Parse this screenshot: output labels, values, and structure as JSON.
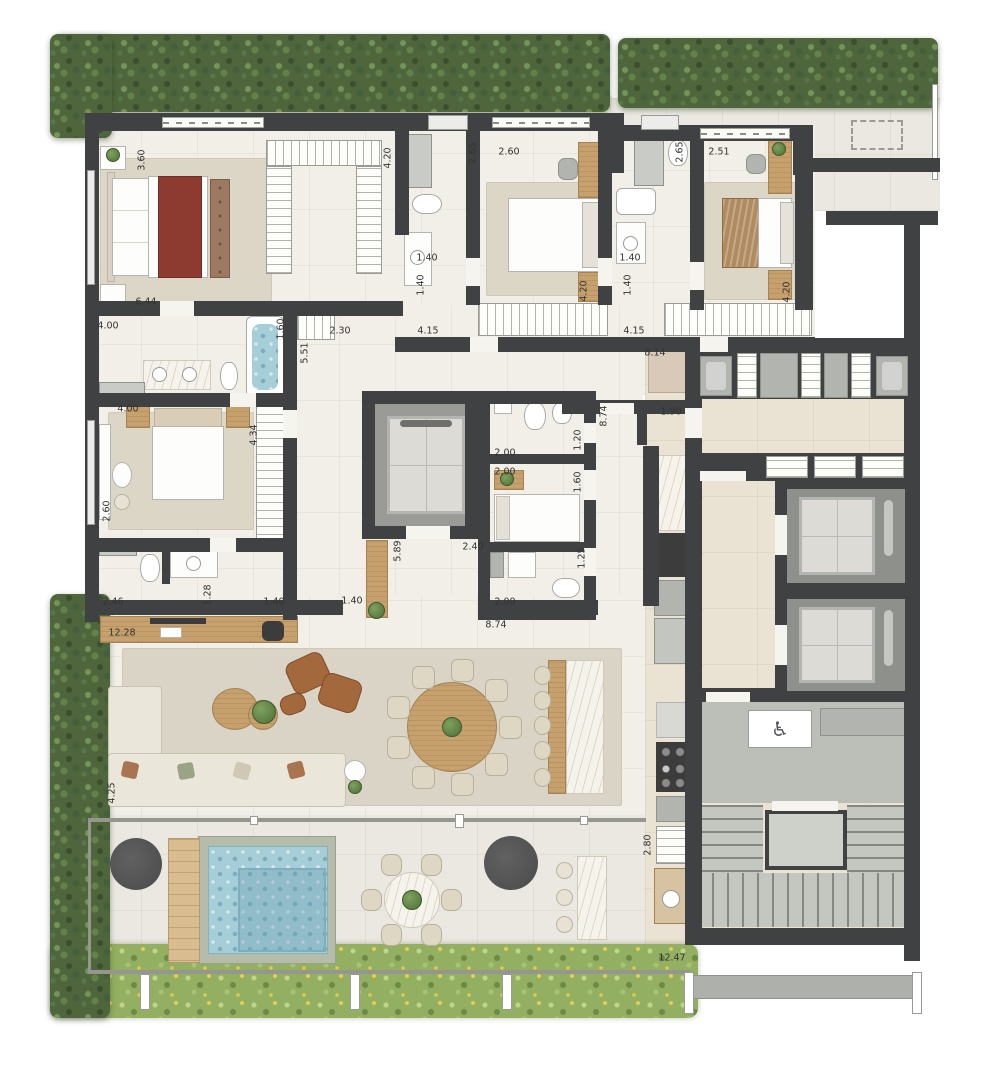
{
  "floorplan": {
    "type": "apartment-floor-plan",
    "icons": {
      "accessibility": "♿"
    },
    "palette": {
      "wall": "#3f4142",
      "floor": "#f2efe8",
      "terrace": "#ebe8e1",
      "hall_tile": "#eae2d2",
      "concrete": "#bcbfb7",
      "pool_water": "#a6ced8",
      "wood": "#c6a06d",
      "hedge_green": "#4f663d",
      "grass_green": "#93af62",
      "bed_accent_red": "#8d3a31",
      "leather_brown": "#a3683c"
    },
    "dimension_labels": [
      {
        "text": "3.60",
        "x": 142,
        "y": 160,
        "rot": 90
      },
      {
        "text": "6.44",
        "x": 146,
        "y": 302,
        "rot": 0
      },
      {
        "text": "4.20",
        "x": 388,
        "y": 158,
        "rot": 90
      },
      {
        "text": "2.65",
        "x": 473,
        "y": 153,
        "rot": 90
      },
      {
        "text": "2.60",
        "x": 509,
        "y": 152,
        "rot": 0
      },
      {
        "text": "1.40",
        "x": 427,
        "y": 258,
        "rot": 0
      },
      {
        "text": "1.40",
        "x": 421,
        "y": 285,
        "rot": 90
      },
      {
        "text": "4.15",
        "x": 428,
        "y": 331,
        "rot": 0
      },
      {
        "text": "2.65",
        "x": 680,
        "y": 152,
        "rot": 90
      },
      {
        "text": "1.40",
        "x": 630,
        "y": 258,
        "rot": 0
      },
      {
        "text": "1.40",
        "x": 628,
        "y": 285,
        "rot": 90
      },
      {
        "text": "4.15",
        "x": 634,
        "y": 331,
        "rot": 0
      },
      {
        "text": "2.51",
        "x": 719,
        "y": 152,
        "rot": 0
      },
      {
        "text": "4.20",
        "x": 584,
        "y": 291,
        "rot": 90
      },
      {
        "text": "4.20",
        "x": 787,
        "y": 292,
        "rot": 90
      },
      {
        "text": "4.00",
        "x": 108,
        "y": 326,
        "rot": 0
      },
      {
        "text": "1.60",
        "x": 281,
        "y": 329,
        "rot": 90
      },
      {
        "text": "2.30",
        "x": 340,
        "y": 331,
        "rot": 0
      },
      {
        "text": "5.51",
        "x": 305,
        "y": 353,
        "rot": 90
      },
      {
        "text": "8.14",
        "x": 655,
        "y": 353,
        "rot": 0
      },
      {
        "text": "4.00",
        "x": 128,
        "y": 409,
        "rot": 0
      },
      {
        "text": "2.60",
        "x": 107,
        "y": 511,
        "rot": 90
      },
      {
        "text": "4.34",
        "x": 254,
        "y": 435,
        "rot": 90
      },
      {
        "text": "8.74",
        "x": 604,
        "y": 416,
        "rot": 90
      },
      {
        "text": "1.90",
        "x": 671,
        "y": 412,
        "rot": 0
      },
      {
        "text": "2.00",
        "x": 505,
        "y": 453,
        "rot": 0
      },
      {
        "text": "1.20",
        "x": 578,
        "y": 440,
        "rot": 90
      },
      {
        "text": "2.00",
        "x": 505,
        "y": 472,
        "rot": 0
      },
      {
        "text": "1.60",
        "x": 578,
        "y": 482,
        "rot": 90
      },
      {
        "text": "2.40",
        "x": 473,
        "y": 547,
        "rot": 0
      },
      {
        "text": "5.89",
        "x": 398,
        "y": 551,
        "rot": 90
      },
      {
        "text": "1.25",
        "x": 582,
        "y": 558,
        "rot": 90
      },
      {
        "text": "2.00",
        "x": 505,
        "y": 602,
        "rot": 0
      },
      {
        "text": "2.46",
        "x": 113,
        "y": 602,
        "rot": 0
      },
      {
        "text": "1.28",
        "x": 208,
        "y": 595,
        "rot": 90
      },
      {
        "text": "1.40",
        "x": 274,
        "y": 602,
        "rot": 0
      },
      {
        "text": "1.40",
        "x": 352,
        "y": 601,
        "rot": 0
      },
      {
        "text": "8.74",
        "x": 496,
        "y": 625,
        "rot": 0
      },
      {
        "text": "12.28",
        "x": 122,
        "y": 633,
        "rot": 0
      },
      {
        "text": "4.25",
        "x": 112,
        "y": 793,
        "rot": 90
      },
      {
        "text": "2.80",
        "x": 648,
        "y": 845,
        "rot": 90
      },
      {
        "text": "12.47",
        "x": 672,
        "y": 958,
        "rot": 0
      }
    ]
  }
}
